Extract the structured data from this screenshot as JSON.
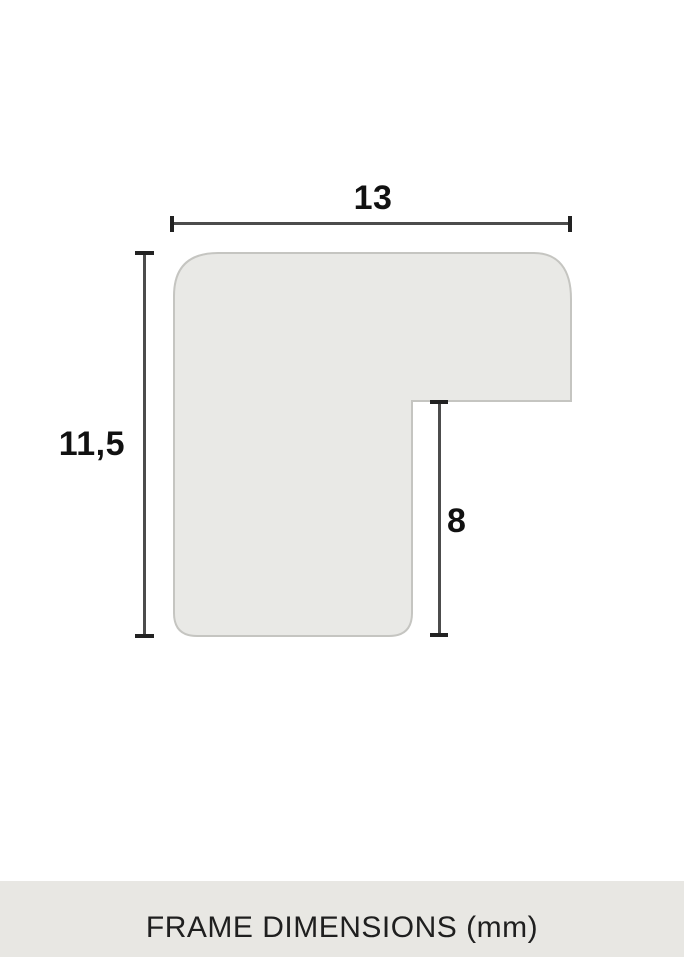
{
  "diagram": {
    "type": "frame-profile-cross-section",
    "labels": {
      "width": "13",
      "height": "11,5",
      "rabbet_depth": "8"
    },
    "colors": {
      "shape_fill": "#e9e9e6",
      "shape_stroke": "#c5c5c1",
      "dimension_line": "#4c4c4c",
      "tick": "#222222",
      "label_text": "#111111"
    }
  },
  "footer": {
    "label": "FRAME DIMENSIONS (mm)",
    "background": "#e8e7e3",
    "text_color": "#1f1f1f"
  }
}
